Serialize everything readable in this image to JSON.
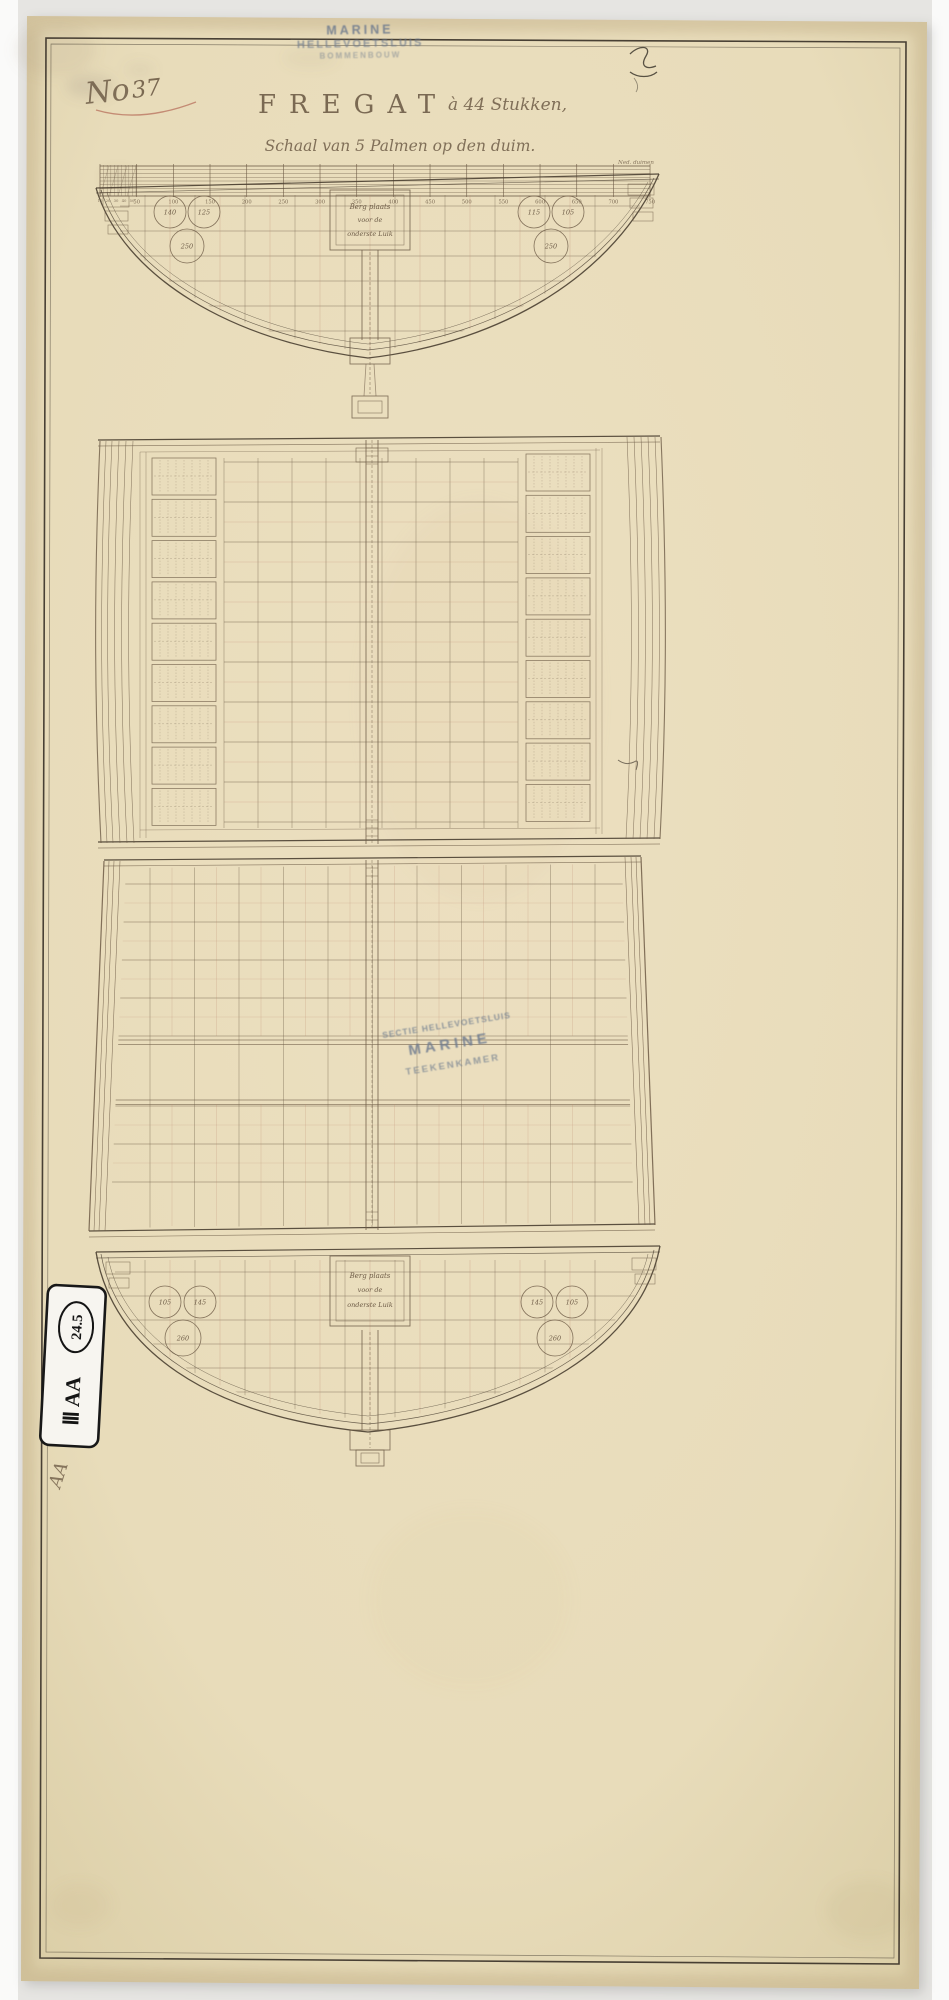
{
  "document": {
    "archive_number_prefix": "No",
    "archive_number": "37",
    "title": "FREGAT",
    "title_suffix": "à 44 Stukken,",
    "subtitle": "Schaal van 5 Palmen op den duim."
  },
  "stamps": {
    "top": {
      "lines": [
        "MARINE",
        "HELLEVOETSLUIS",
        "BOMMENBOUW"
      ]
    },
    "center": {
      "lines": [
        "SECTIE HELLEVOETSLUIS",
        "MARINE",
        "TEEKENKAMER"
      ]
    }
  },
  "scale_bar": {
    "minor_labels": [
      "10",
      "20",
      "30",
      "40",
      "50"
    ],
    "major_labels": [
      "50",
      "100",
      "150",
      "200",
      "250",
      "300",
      "350",
      "400",
      "450",
      "500",
      "550",
      "600",
      "650",
      "700",
      "750"
    ],
    "unit_label": "Ned. duimen"
  },
  "top_section": {
    "storage_box_lines": [
      "Berg plaats",
      "voor de",
      "onderste Luik"
    ],
    "left_circles": [
      "140",
      "125",
      "250"
    ],
    "right_circles": [
      "115",
      "105",
      "250"
    ]
  },
  "bottom_section": {
    "storage_box_lines": [
      "Berg plaats",
      "voor de",
      "onderste Luik"
    ],
    "left_circles": [
      "105",
      "145",
      "260"
    ],
    "right_circles": [
      "145",
      "105",
      "260"
    ]
  },
  "labels": {
    "archival_label": "Ⅲ AA",
    "archival_label_circled": "24.5",
    "handwritten_mark": "AA"
  },
  "colors": {
    "paper": "#e8dcba",
    "ink": "#6e5c47",
    "outline": "#4a3f31",
    "red_line": "#bd8870",
    "stamp_blue": "#6d7a8e",
    "number_red": "#a5493b"
  }
}
